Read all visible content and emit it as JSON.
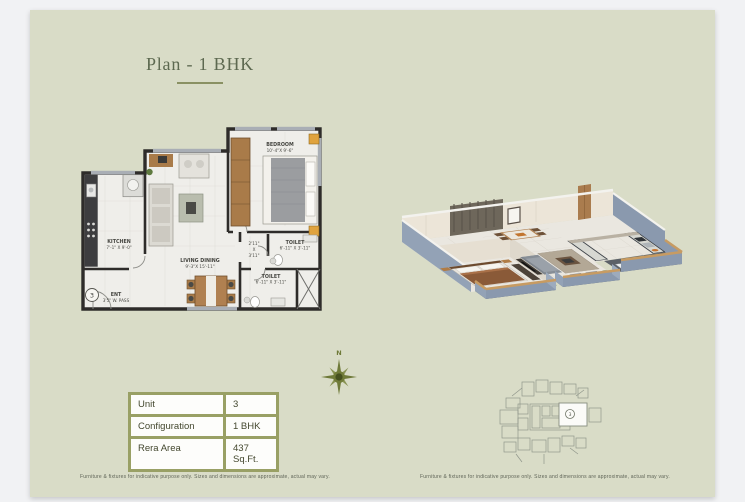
{
  "page": {
    "title": "Plan - 1 BHK",
    "disclaimer": "Furniture & fixtures for indicative purpose only. Sizes and dimensions are approximate, actual may vary.",
    "colors": {
      "background": "#f1f2f4",
      "card": "#d9dcc7",
      "accent_olive": "#5d6950",
      "table_frame": "#99a065",
      "wall_dark": "#2e2c2a",
      "wall_blue_gray": "#8a99ae",
      "wood_trim": "#c79b62"
    }
  },
  "floorplan": {
    "unit_marker": "3",
    "rooms": {
      "kitchen": {
        "name": "KITCHEN",
        "dims": "7'-1\" X 9'-0\""
      },
      "living": {
        "name": "LIVING DINING",
        "dims": "9'-3\"X 15'-11\""
      },
      "bedroom": {
        "name": "BEDROOM",
        "dims": "10'-4\"X 9'-6\""
      },
      "toilet_top": {
        "name": "TOILET",
        "dims": "6'-11\" X 3'-11\""
      },
      "toilet_bottom": {
        "name": "TOILET",
        "dims": "6'-11\" X 3'-11\""
      },
      "passage": {
        "l1": "2'11\"",
        "l2": "X",
        "l3": "3'11\""
      },
      "entrance": {
        "name": "ENT",
        "dims": "3'5\" W. PASS"
      }
    }
  },
  "compass": {
    "north_label": "N"
  },
  "details_table": {
    "rows": [
      {
        "label": "Unit",
        "value": "3"
      },
      {
        "label": "Configuration",
        "value": "1 BHK"
      },
      {
        "label": "Rera Area",
        "value": "437 Sq.Ft."
      }
    ]
  },
  "keyplan": {
    "highlight_unit": "3"
  }
}
